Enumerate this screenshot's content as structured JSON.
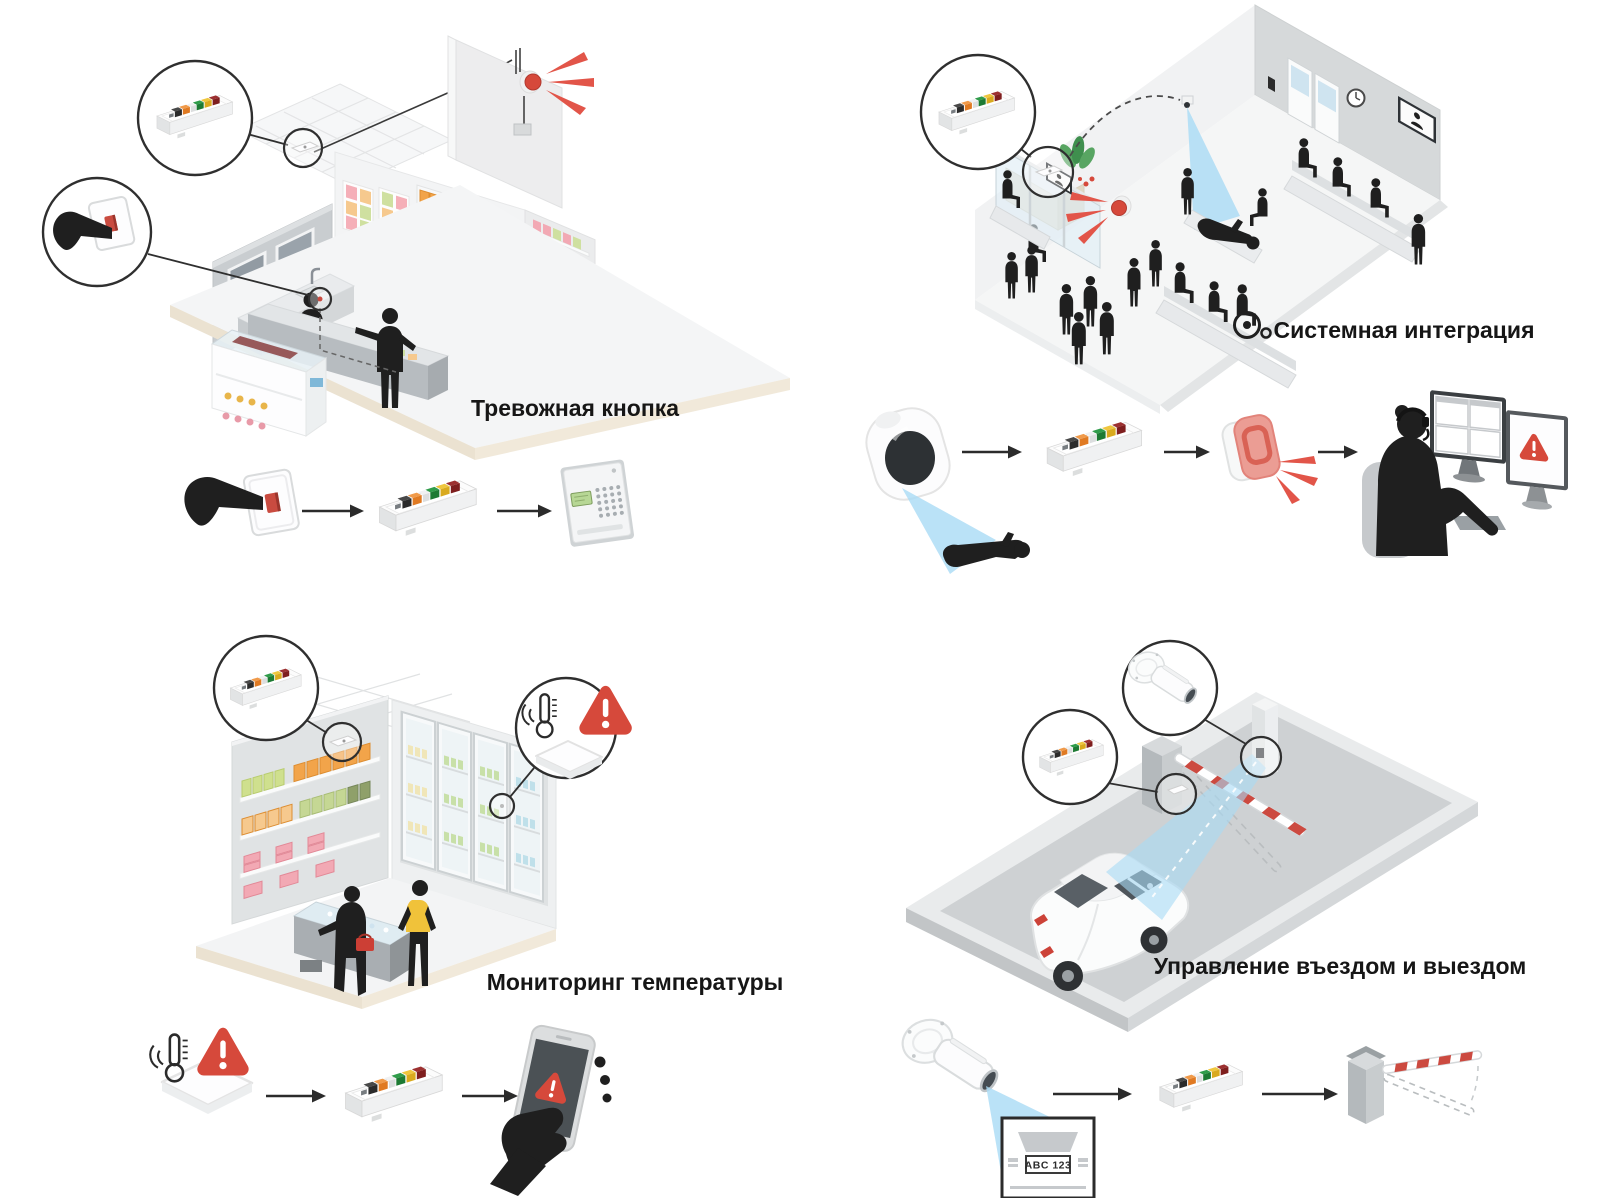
{
  "canvas": {
    "width": 1598,
    "height": 1198,
    "background": "#ffffff"
  },
  "scenes": [
    {
      "id": "panic-button",
      "title": "Тревожная кнопка",
      "flow_icons": [
        "panic-button-press-icon",
        "io-relay-device-icon",
        "alarm-keypad-icon"
      ]
    },
    {
      "id": "system-integration",
      "title": "Системная интеграция",
      "flow_icons": [
        "dome-camera-icon",
        "io-relay-device-icon",
        "strobe-siren-icon",
        "operator-workstation-icon"
      ]
    },
    {
      "id": "temperature-monitoring",
      "title": "Мониторинг температуры",
      "flow_icons": [
        "temperature-sensor-icon",
        "io-relay-device-icon",
        "smartphone-alert-icon"
      ]
    },
    {
      "id": "entry-exit-management",
      "title": "Управление въездом и выездом",
      "license_plate": "ABC 123",
      "flow_icons": [
        "license-plate-camera-icon",
        "io-relay-device-icon",
        "barrier-gate-icon"
      ]
    }
  ],
  "colors": {
    "warning_red": "#d6493b",
    "siren_red": "#e25549",
    "cone_blue": "#a9dbf5",
    "silhouette_black": "#1f1f1f",
    "floor_beige": "#ebe2d1",
    "terminal_black": "#2b2b2b",
    "terminal_orange": "#e07a22",
    "terminal_green": "#1d7a33",
    "terminal_yellow": "#d9aa1e",
    "terminal_dark_red": "#7e1e1e",
    "basket_red": "#cc3f35",
    "vest_yellow": "#f0c23a",
    "barrier_stripe_red": "#cc4a40"
  }
}
